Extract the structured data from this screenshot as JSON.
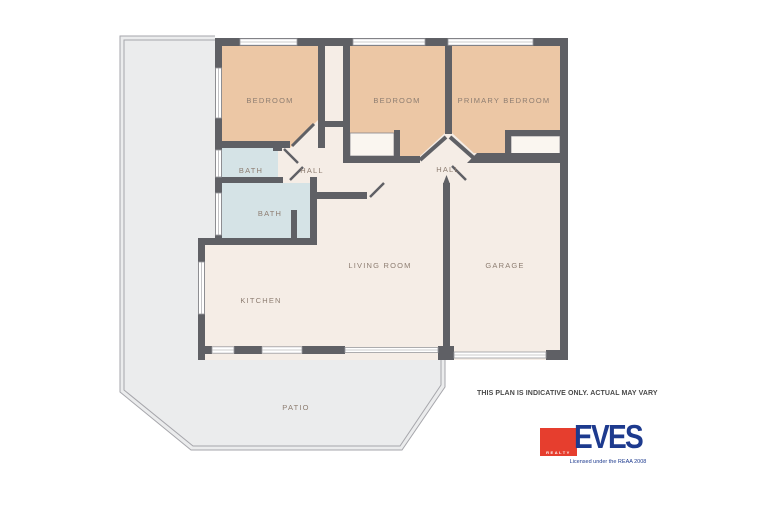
{
  "plan": {
    "rooms": [
      {
        "id": "bedroom-1",
        "label": "BEDROOM"
      },
      {
        "id": "bedroom-2",
        "label": "BEDROOM"
      },
      {
        "id": "primary-bedroom",
        "label": "PRIMARY BEDROOM"
      },
      {
        "id": "bath-1",
        "label": "BATH"
      },
      {
        "id": "bath-2",
        "label": "BATH"
      },
      {
        "id": "hall-left",
        "label": "HALL"
      },
      {
        "id": "hall-right",
        "label": "HALL"
      },
      {
        "id": "living-room",
        "label": "LIVING ROOM"
      },
      {
        "id": "kitchen",
        "label": "KITCHEN"
      },
      {
        "id": "garage",
        "label": "GARAGE"
      },
      {
        "id": "patio",
        "label": "PATIO"
      }
    ],
    "colors": {
      "bedroom": "#ecc7a5",
      "bath": "#d5e3e6",
      "floor": "#f5ede6",
      "wall": "#5f6065",
      "patio": "#ebeced",
      "patio-outline": "#a6a6ab",
      "label": "#8d7d71"
    }
  },
  "disclaimer": "THIS PLAN IS INDICATIVE ONLY. ACTUAL MAY VARY",
  "logo": {
    "brand": "EVES",
    "sub": "REALTY",
    "tagline": "Licensed under the REAA 2008",
    "red": "#e63e2e",
    "navy": "#1d3a8e"
  }
}
